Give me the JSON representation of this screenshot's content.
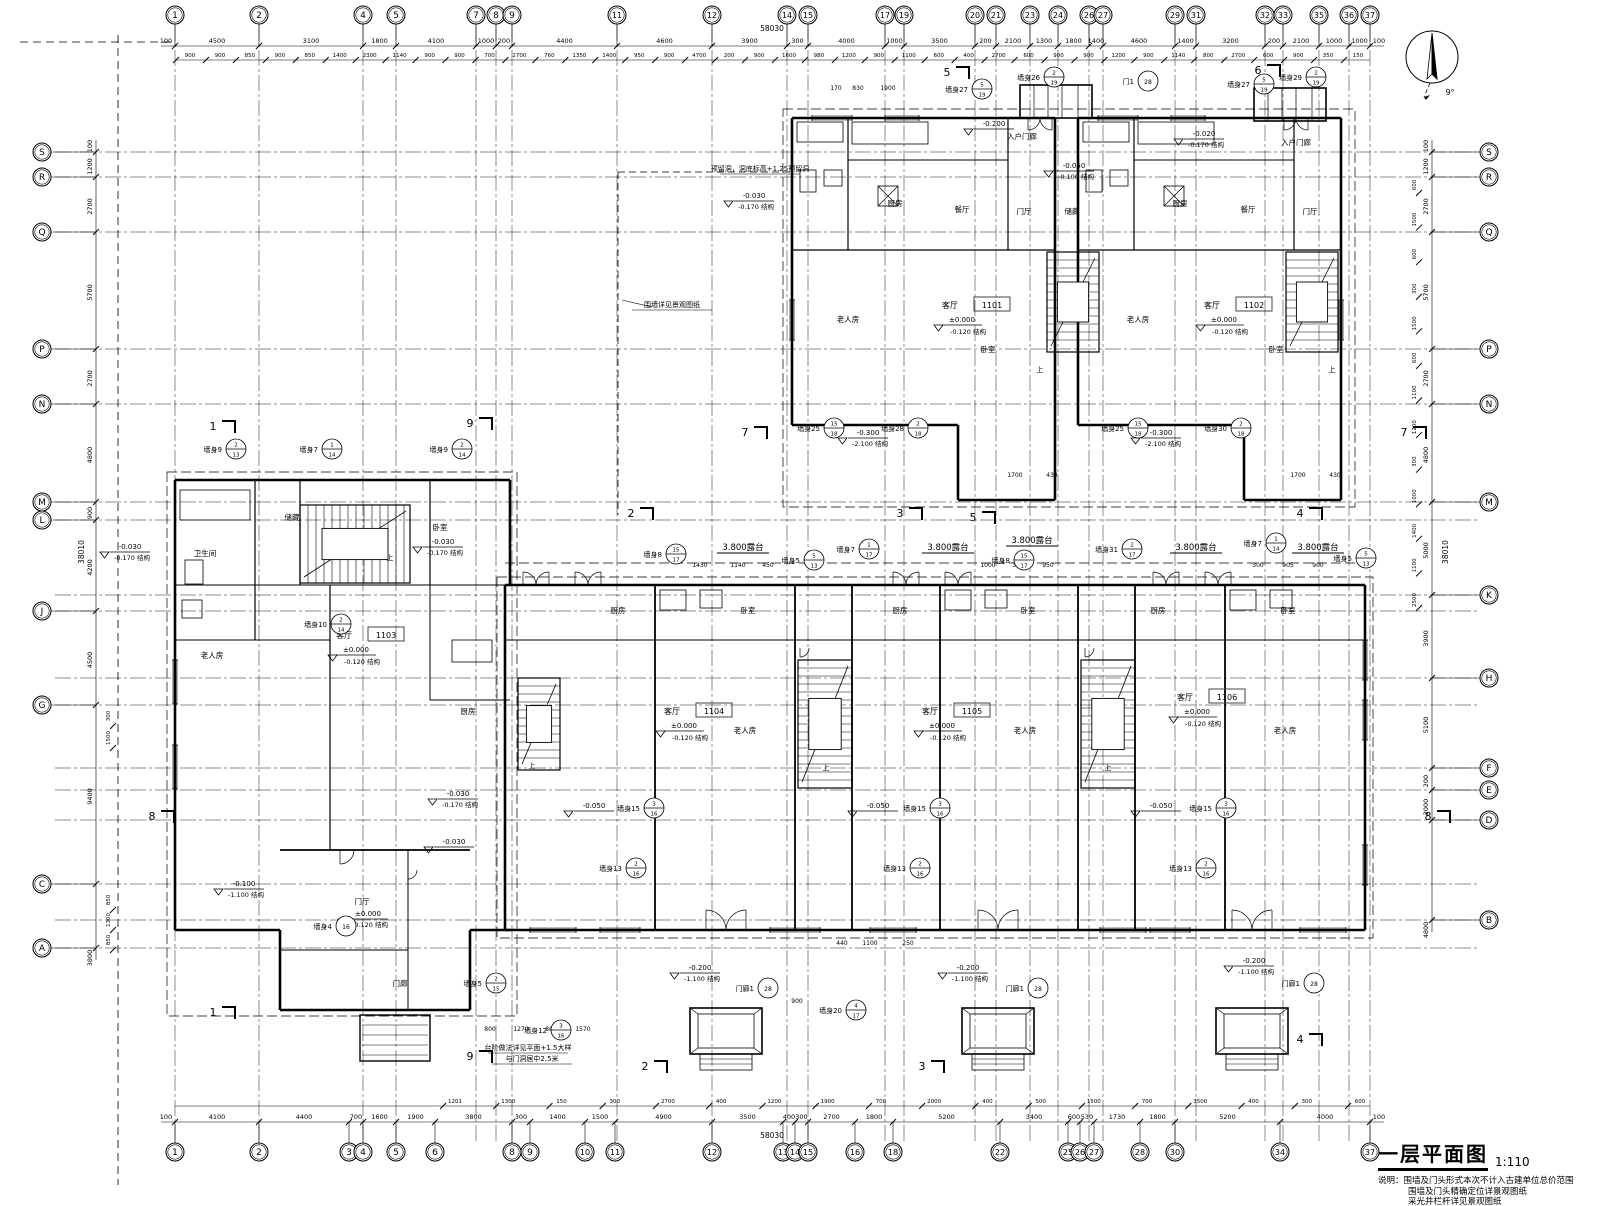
{
  "title": "一层平面图",
  "scale": "1:110",
  "notes": [
    "说明：围墙及门头形式本次不计入古建单位总价范围",
    "围墙及门头精确定位详景观图纸",
    "采光井栏杆详见景观图纸"
  ],
  "north": {
    "angle_label": "9°"
  },
  "totals": {
    "top": "58030",
    "bottom": "58030",
    "left": "38010",
    "right": "38010"
  },
  "grid": {
    "top": [
      [
        "1",
        175
      ],
      [
        "2",
        259
      ],
      [
        "4",
        363
      ],
      [
        "5",
        396
      ],
      [
        "7",
        476
      ],
      [
        "8",
        496
      ],
      [
        "9",
        512
      ],
      [
        "11",
        617
      ],
      [
        "12",
        712
      ],
      [
        "14",
        787
      ],
      [
        "15",
        808
      ],
      [
        "17",
        885
      ],
      [
        "19",
        904
      ],
      [
        "20",
        975
      ],
      [
        "21",
        996
      ],
      [
        "23",
        1030
      ],
      [
        "24",
        1058
      ],
      [
        "26",
        1089
      ],
      [
        "27",
        1103
      ],
      [
        "29",
        1175
      ],
      [
        "31",
        1196
      ],
      [
        "32",
        1265
      ],
      [
        "33",
        1283
      ],
      [
        "35",
        1319
      ],
      [
        "36",
        1349
      ],
      [
        "37",
        1370
      ]
    ],
    "bottom": [
      [
        "1",
        175
      ],
      [
        "2",
        259
      ],
      [
        "3",
        349
      ],
      [
        "4",
        363
      ],
      [
        "5",
        396
      ],
      [
        "6",
        435
      ],
      [
        "8",
        512
      ],
      [
        "9",
        530
      ],
      [
        "10",
        585
      ],
      [
        "11",
        615
      ],
      [
        "12",
        712
      ],
      [
        "13",
        783
      ],
      [
        "14",
        795
      ],
      [
        "15",
        808
      ],
      [
        "16",
        855
      ],
      [
        "18",
        893
      ],
      [
        "22",
        1000
      ],
      [
        "25",
        1068
      ],
      [
        "26",
        1080
      ],
      [
        "27",
        1094
      ],
      [
        "28",
        1140
      ],
      [
        "30",
        1175
      ],
      [
        "34",
        1280
      ],
      [
        "37",
        1370
      ]
    ],
    "left": [
      [
        "S",
        152
      ],
      [
        "R",
        177
      ],
      [
        "Q",
        232
      ],
      [
        "P",
        349
      ],
      [
        "N",
        404
      ],
      [
        "M",
        502
      ],
      [
        "L",
        520
      ],
      [
        "J",
        611
      ],
      [
        "G",
        705
      ],
      [
        "C",
        884
      ],
      [
        "A",
        948
      ]
    ],
    "right": [
      [
        "S",
        152
      ],
      [
        "R",
        177
      ],
      [
        "Q",
        232
      ],
      [
        "P",
        349
      ],
      [
        "N",
        404
      ],
      [
        "M",
        502
      ],
      [
        "K",
        595
      ],
      [
        "H",
        678
      ],
      [
        "F",
        768
      ],
      [
        "E",
        790
      ],
      [
        "D",
        820
      ],
      [
        "B",
        920
      ]
    ]
  },
  "dims": {
    "top_main": [
      "100",
      "4500",
      "3100",
      "1800",
      "4100",
      "1000",
      "200",
      "4400",
      "4600",
      "3900",
      "300",
      "4000",
      "1000",
      "3500",
      "200",
      "2100",
      "1300",
      "1800",
      "1400",
      "4600",
      "1400",
      "3200",
      "200",
      "2100",
      "1000",
      "1000",
      "100"
    ],
    "bottom_main": [
      "100",
      "4100",
      "4400",
      "700",
      "1600",
      "1900",
      "3800",
      "300",
      "1400",
      "1500",
      "4900",
      "3500",
      "400",
      "300",
      "2700",
      "1800",
      "5200",
      "3400",
      "600",
      "530",
      "1730",
      "1800",
      "5200",
      "4000",
      "100"
    ],
    "left_main": [
      "100",
      "1200",
      "2700",
      "5700",
      "2700",
      "4800",
      "900",
      "4200",
      "4500",
      "9400",
      "3800"
    ],
    "right_main": [
      "100",
      "1200",
      "2700",
      "5700",
      "2700",
      "4800",
      "5000",
      "3900",
      "5100",
      "200",
      "2000",
      "4800"
    ],
    "top_sub": [
      "900",
      "900",
      "850",
      "900",
      "850",
      "1400",
      "2300",
      "1140",
      "900",
      "900",
      "700",
      "2700",
      "760",
      "1350",
      "1400",
      "950",
      "900",
      "4700",
      "200",
      "900",
      "1600",
      "980",
      "1200",
      "900",
      "1100",
      "600",
      "400",
      "2700",
      "600",
      "900",
      "900",
      "1200",
      "900",
      "1140",
      "800",
      "2700",
      "600",
      "900",
      "350",
      "150"
    ],
    "bottom_sub": [
      "1201",
      "1300",
      "150",
      "300",
      "2700",
      "400",
      "1200",
      "1900",
      "700",
      "2000",
      "400",
      "500",
      "1500",
      "700",
      "3500",
      "400",
      "300",
      "600"
    ],
    "left_sub": [
      "300",
      "1500",
      "850",
      "1300",
      "850"
    ],
    "right_sub": [
      "600",
      "1500",
      "600",
      "300",
      "1500",
      "600",
      "1100",
      "1200",
      "300",
      "1000",
      "1400",
      "1100",
      "2500"
    ]
  },
  "units": [
    [
      "1101",
      978,
      306
    ],
    [
      "1102",
      1240,
      306
    ],
    [
      "1103",
      372,
      636
    ],
    [
      "1104",
      700,
      712
    ],
    [
      "1105",
      958,
      712
    ],
    [
      "1106",
      1213,
      698
    ]
  ],
  "unit_room_label": "客厅",
  "unit_levels": [
    "±0.000",
    "-0.120 结构"
  ],
  "rooms": [
    [
      848,
      322,
      "老人房"
    ],
    [
      895,
      206,
      "厨房"
    ],
    [
      962,
      212,
      "餐厅"
    ],
    [
      1024,
      214,
      "门厅"
    ],
    [
      1072,
      214,
      "储藏"
    ],
    [
      1022,
      139,
      "入户门廊"
    ],
    [
      988,
      352,
      "卧室"
    ],
    [
      1138,
      322,
      "老人房"
    ],
    [
      1180,
      206,
      "厨房"
    ],
    [
      1248,
      212,
      "餐厅"
    ],
    [
      1310,
      214,
      "门厅"
    ],
    [
      1296,
      145,
      "入户门廊"
    ],
    [
      1276,
      352,
      "卧室"
    ],
    [
      212,
      658,
      "老人房"
    ],
    [
      292,
      520,
      "储藏"
    ],
    [
      468,
      714,
      "厨房"
    ],
    [
      362,
      904,
      "门厅"
    ],
    [
      400,
      986,
      "门廊"
    ],
    [
      205,
      556,
      "卫生间"
    ],
    [
      440,
      530,
      "卧室"
    ],
    [
      618,
      613,
      "厨房"
    ],
    [
      748,
      613,
      "卧室"
    ],
    [
      745,
      733,
      "老人房"
    ],
    [
      900,
      613,
      "厨房"
    ],
    [
      1028,
      613,
      "卧室"
    ],
    [
      1025,
      733,
      "老人房"
    ],
    [
      1158,
      613,
      "厨房"
    ],
    [
      1288,
      613,
      "卧室"
    ],
    [
      1285,
      733,
      "老人房"
    ],
    [
      1040,
      372,
      "上"
    ],
    [
      1332,
      372,
      "上"
    ],
    [
      826,
      770,
      "上"
    ],
    [
      1108,
      770,
      "上"
    ],
    [
      390,
      560,
      "上"
    ],
    [
      532,
      768,
      "上"
    ]
  ],
  "levels": [
    [
      988,
      126,
      "-0.200",
      ""
    ],
    [
      1068,
      168,
      "-0.050",
      "-0.100 结构"
    ],
    [
      1198,
      136,
      "-0.020",
      "-0.170 结构"
    ],
    [
      748,
      198,
      "-0.030",
      "-0.170 结构"
    ],
    [
      862,
      435,
      "-0.300",
      "-2.100 结构"
    ],
    [
      1155,
      435,
      "-0.300",
      "-2.100 结构"
    ],
    [
      437,
      544,
      "-0.030",
      "-0.170 结构"
    ],
    [
      124,
      549,
      "-0.030",
      "-0.170 结构"
    ],
    [
      452,
      796,
      "-0.030",
      "-0.170 结构"
    ],
    [
      588,
      808,
      "-0.050",
      ""
    ],
    [
      872,
      808,
      "-0.050",
      ""
    ],
    [
      1155,
      808,
      "-0.050",
      ""
    ],
    [
      694,
      970,
      "-0.200",
      "-1.100 结构"
    ],
    [
      962,
      970,
      "-0.200",
      "-1.100 结构"
    ],
    [
      1248,
      963,
      "-0.200",
      "-1.100 结构"
    ],
    [
      238,
      886,
      "-0.100",
      "-1.100 结构"
    ],
    [
      362,
      916,
      "±0.000",
      "-0.120 结构"
    ],
    [
      448,
      844,
      "-0.030",
      ""
    ]
  ],
  "terrace_label": "3.800露台",
  "terraces": [
    [
      743,
      550
    ],
    [
      948,
      550
    ],
    [
      1032,
      543
    ],
    [
      1196,
      550
    ],
    [
      1318,
      550
    ]
  ],
  "callouts": [
    [
      662,
      557,
      "墙身8",
      "15",
      "17"
    ],
    [
      800,
      563,
      "墙身5",
      "5",
      "13"
    ],
    [
      855,
      552,
      "墙身7",
      "1",
      "17"
    ],
    [
      1010,
      563,
      "墙身8",
      "15",
      "17"
    ],
    [
      1118,
      552,
      "墙身31",
      "2",
      "17"
    ],
    [
      1262,
      546,
      "墙身7",
      "1",
      "14"
    ],
    [
      1352,
      561,
      "墙身5",
      "5",
      "13"
    ],
    [
      968,
      92,
      "墙身27",
      "5",
      "19"
    ],
    [
      1040,
      80,
      "墙身26",
      "2",
      "19"
    ],
    [
      1134,
      84,
      "门1",
      "",
      "28"
    ],
    [
      1250,
      87,
      "墙身27",
      "5",
      "19"
    ],
    [
      1302,
      80,
      "墙身29",
      "2",
      "19"
    ],
    [
      820,
      431,
      "墙身25",
      "15",
      "18"
    ],
    [
      904,
      431,
      "墙身28",
      "2",
      "18"
    ],
    [
      1124,
      431,
      "墙身25",
      "15",
      "18"
    ],
    [
      1227,
      431,
      "墙身30",
      "2",
      "18"
    ],
    [
      222,
      452,
      "墙身9",
      "2",
      "13"
    ],
    [
      318,
      452,
      "墙身7",
      "1",
      "14"
    ],
    [
      448,
      452,
      "墙身9",
      "2",
      "14"
    ],
    [
      332,
      929,
      "墙身4",
      "",
      "16"
    ],
    [
      482,
      986,
      "墙身5",
      "2",
      "15"
    ],
    [
      547,
      1033,
      "墙身12",
      "3",
      "16"
    ],
    [
      622,
      871,
      "墙身13",
      "2",
      "16"
    ],
    [
      906,
      871,
      "墙身13",
      "2",
      "16"
    ],
    [
      1192,
      871,
      "墙身13",
      "2",
      "16"
    ],
    [
      842,
      1013,
      "墙身20",
      "4",
      "17"
    ],
    [
      640,
      811,
      "墙身15",
      "3",
      "16"
    ],
    [
      926,
      811,
      "墙身15",
      "3",
      "16"
    ],
    [
      1212,
      811,
      "墙身15",
      "3",
      "16"
    ],
    [
      754,
      991,
      "门廊1",
      "",
      "28"
    ],
    [
      1024,
      991,
      "门廊1",
      "",
      "28"
    ],
    [
      1300,
      986,
      "门廊1",
      "",
      "28"
    ],
    [
      327,
      627,
      "墙身10",
      "2",
      "14"
    ]
  ],
  "sections": [
    [
      213,
      430,
      "1"
    ],
    [
      213,
      1016,
      "1"
    ],
    [
      470,
      427,
      "9"
    ],
    [
      470,
      1060,
      "9"
    ],
    [
      631,
      517,
      "2"
    ],
    [
      645,
      1070,
      "2"
    ],
    [
      900,
      517,
      "3"
    ],
    [
      922,
      1070,
      "3"
    ],
    [
      973,
      521,
      "5"
    ],
    [
      947,
      76,
      "5"
    ],
    [
      1258,
      74,
      "6"
    ],
    [
      1300,
      517,
      "4"
    ],
    [
      1300,
      1043,
      "4"
    ],
    [
      745,
      436,
      "7"
    ],
    [
      1404,
      436,
      "7"
    ],
    [
      152,
      820,
      "8"
    ],
    [
      1428,
      820,
      "8"
    ]
  ],
  "misc_texts": [
    [
      760,
      171,
      "预留洞，洞底标高+1.25预留洞"
    ],
    [
      672,
      307,
      "围墙详见景观图纸"
    ],
    [
      528,
      1050,
      "台阶做法详见平面+1.5大样"
    ],
    [
      532,
      1061,
      "与门洞居中2.5米"
    ]
  ],
  "inner_dims": [
    [
      1015,
      477,
      "1700"
    ],
    [
      1052,
      477,
      "430"
    ],
    [
      1298,
      477,
      "1700"
    ],
    [
      1335,
      477,
      "430"
    ],
    [
      700,
      567,
      "1430"
    ],
    [
      738,
      567,
      "1140"
    ],
    [
      768,
      567,
      "450"
    ],
    [
      988,
      567,
      "1000"
    ],
    [
      1018,
      567,
      "300"
    ],
    [
      1048,
      567,
      "950"
    ],
    [
      1258,
      567,
      "300"
    ],
    [
      1288,
      567,
      "905"
    ],
    [
      1318,
      567,
      "900"
    ],
    [
      490,
      1031,
      "800"
    ],
    [
      521,
      1031,
      "1270"
    ],
    [
      551,
      1031,
      "800"
    ],
    [
      583,
      1031,
      "1570"
    ],
    [
      797,
      1003,
      "900"
    ],
    [
      842,
      945,
      "440"
    ],
    [
      870,
      945,
      "1100"
    ],
    [
      908,
      945,
      "250"
    ],
    [
      836,
      90,
      "170"
    ],
    [
      858,
      90,
      "830"
    ],
    [
      888,
      90,
      "1900"
    ]
  ]
}
